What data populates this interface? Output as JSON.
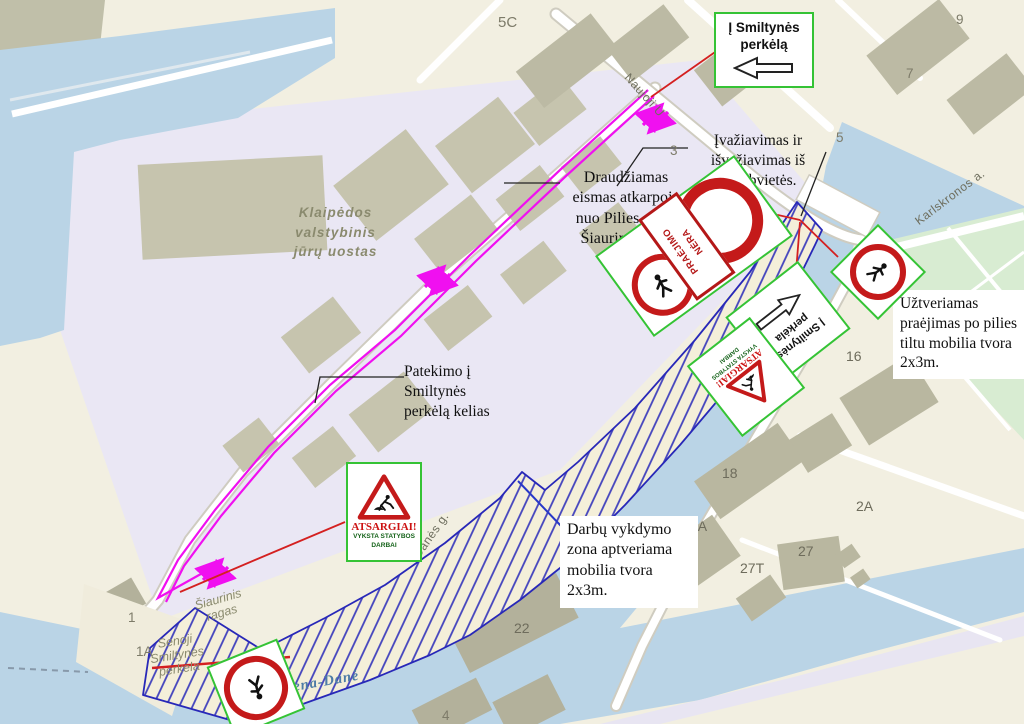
{
  "callouts": {
    "to_ferry_box": "Į Smiltynės\nperkėlą",
    "entry_exit": "Įvažiavimas ir\nišvažiavimas iš\nstatybvietės.",
    "forbidden_section": "Draudžiamas\neismas atkarpoje\nnuo Pilies g. iki\nŠiaurinio rago",
    "closed_passage": "Užtveriamas\npraėjimas po pilies\ntiltu mobilia tvora\n2x3m.",
    "access_road": "Patekimo į\nSmiltynės\nperkėlą kelias",
    "work_zone": "Darbų vykdymo\nzona aptveriama\nmobilia tvora\n2x3m."
  },
  "signs": {
    "atsargiai_title": "ATSARGIAI!",
    "atsargiai_sub": "VYKSTA STATYBOS\nDARBAI",
    "praejimo_nera": "PRAĖJIMO\nNĖRA",
    "to_ferry_rotated": "Į Smiltynės\nperkėla"
  },
  "map": {
    "port_label": "Klaipėdos\nvalstybinis\njūrų uostas",
    "river_label": "Akmena-Danė",
    "cape_label": "Šiaurinis\nragas",
    "old_ferry_label": "Senoji\nSmiltynės\nperkėla",
    "streets": {
      "naujoji": "Naujoji U",
      "danes_a": "Danės g.",
      "danes_b": "Danės g.",
      "karlskronos": "Karlskronos a."
    },
    "numbers": {
      "n5c": "5C",
      "n9": "9",
      "n7": "7",
      "n5": "5",
      "n3": "3",
      "n16": "16",
      "n16a": "16A",
      "n18": "18",
      "n8a": "8A",
      "n2a": "2A",
      "n27": "27",
      "n27t": "27T",
      "n25": "25",
      "n22": "22",
      "n1": "1",
      "n1a": "1A",
      "n4": "4"
    }
  },
  "colors": {
    "water": "#bad4e6",
    "port_land": "#eae7f4",
    "land": "#f2efe1",
    "building": "#c6c4ae",
    "park": "#d8ecd2",
    "route_magenta": "#f010f0",
    "zone_outline": "#2828b8",
    "sign_green": "#35c335",
    "sign_red": "#c41a1a",
    "red_line": "#d42020"
  }
}
